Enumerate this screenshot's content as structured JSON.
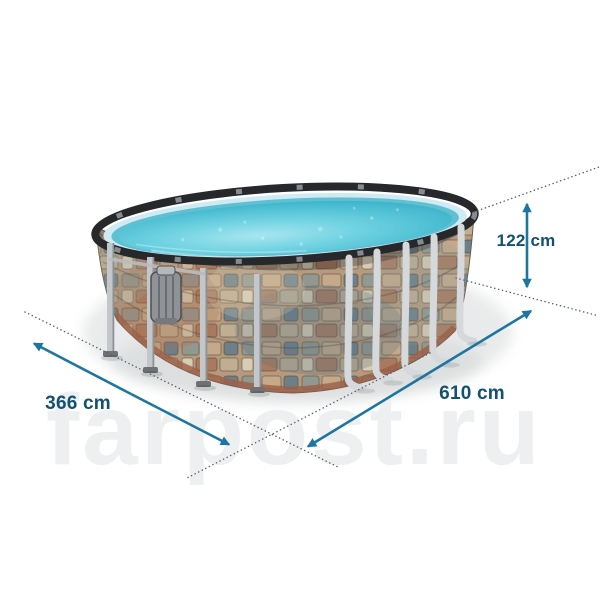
{
  "watermark": {
    "text": "farpost.ru"
  },
  "annotations": {
    "height_label": "122 cm",
    "width_label": "366 cm",
    "length_label": "610 cm"
  },
  "colors": {
    "background": "#ffffff",
    "label_text": "#14516f",
    "dimension_accent": "#1c76a0",
    "extension_line": "#55606a",
    "water": "#55c4d8",
    "liner": "#cfeaf2",
    "rim_dark": "#26282b",
    "stone_tan": "#c0a584",
    "stone_rust": "#a96f52",
    "stone_slate": "#64767f",
    "frame_gray": "#c3c7ca",
    "watermark_gray": "#edeff0"
  }
}
